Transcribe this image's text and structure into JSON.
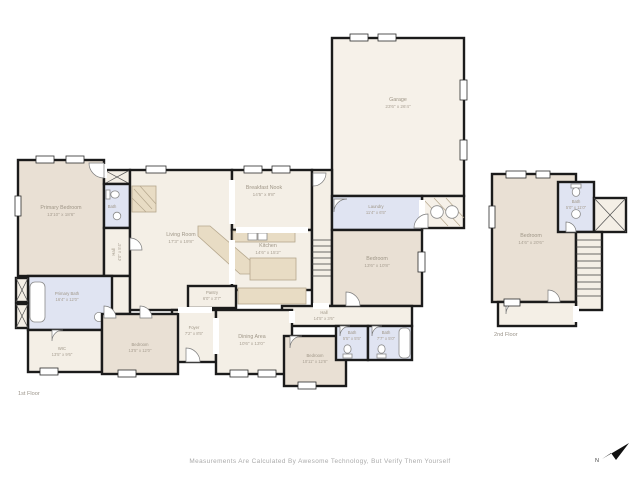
{
  "footer": {
    "disclaimer": "Measurements Are Calculated By Awesome Technology, But Verify Them Yourself"
  },
  "floors": {
    "first": "1st Floor",
    "second": "2nd Floor"
  },
  "compass": {
    "letter": "N"
  },
  "colors": {
    "wall": "#1b1b1b",
    "room_warm": "#e9e0d4",
    "room_cream": "#f4efe6",
    "room_bath": "#e0e4f2",
    "counter": "#e8dcc4",
    "label_text": "#9f9687"
  },
  "rooms": {
    "primary_bedroom": {
      "name": "Primary Bedroom",
      "dims": "13'10\" x 18'6\""
    },
    "bath_front": {
      "name": "Bath",
      "dims": ""
    },
    "hall_front": {
      "name": "Hall",
      "dims": "4'0\" x 5'4\""
    },
    "living_room": {
      "name": "Living Room",
      "dims": "17'3\" x 19'8\""
    },
    "breakfast_nook": {
      "name": "Breakfast Nook",
      "dims": "14'5\" x 9'8\""
    },
    "kitchen": {
      "name": "Kitchen",
      "dims": "14'6\" x 15'2\""
    },
    "garage": {
      "name": "Garage",
      "dims": "23'6\" x 26'4\""
    },
    "laundry": {
      "name": "Laundry",
      "dims": "11'4\" x 6'5\""
    },
    "bedroom_right": {
      "name": "Bedroom",
      "dims": "13'6\" x 10'8\""
    },
    "pantry": {
      "name": "Pantry",
      "dims": "6'0\" x 3'7\""
    },
    "hall_main": {
      "name": "Hall",
      "dims": "14'5\" x 3'6\""
    },
    "foyer": {
      "name": "Foyer",
      "dims": "7'2\" x 8'5\""
    },
    "dining_area": {
      "name": "Dining Area",
      "dims": "10'6\" x 13'0\""
    },
    "bedroom_bottom": {
      "name": "Bedroom",
      "dims": "10'11\" x 12'8\""
    },
    "bath_hall": {
      "name": "Bath",
      "dims": "5'5\" x 5'5\""
    },
    "bath_right": {
      "name": "Bath",
      "dims": "7'7\" x 5'0\""
    },
    "primary_bath": {
      "name": "Primary Bath",
      "dims": "16'4\" x 12'0\""
    },
    "wic": {
      "name": "WIC",
      "dims": "13'5\" x 9'6\""
    },
    "bedroom_left": {
      "name": "Bedroom",
      "dims": "13'5\" x 12'0\""
    },
    "bedroom_2nd": {
      "name": "Bedroom",
      "dims": "14'6\" x 20'6\""
    },
    "bath_2nd": {
      "name": "Bath",
      "dims": "5'0\" x 11'0\""
    }
  }
}
